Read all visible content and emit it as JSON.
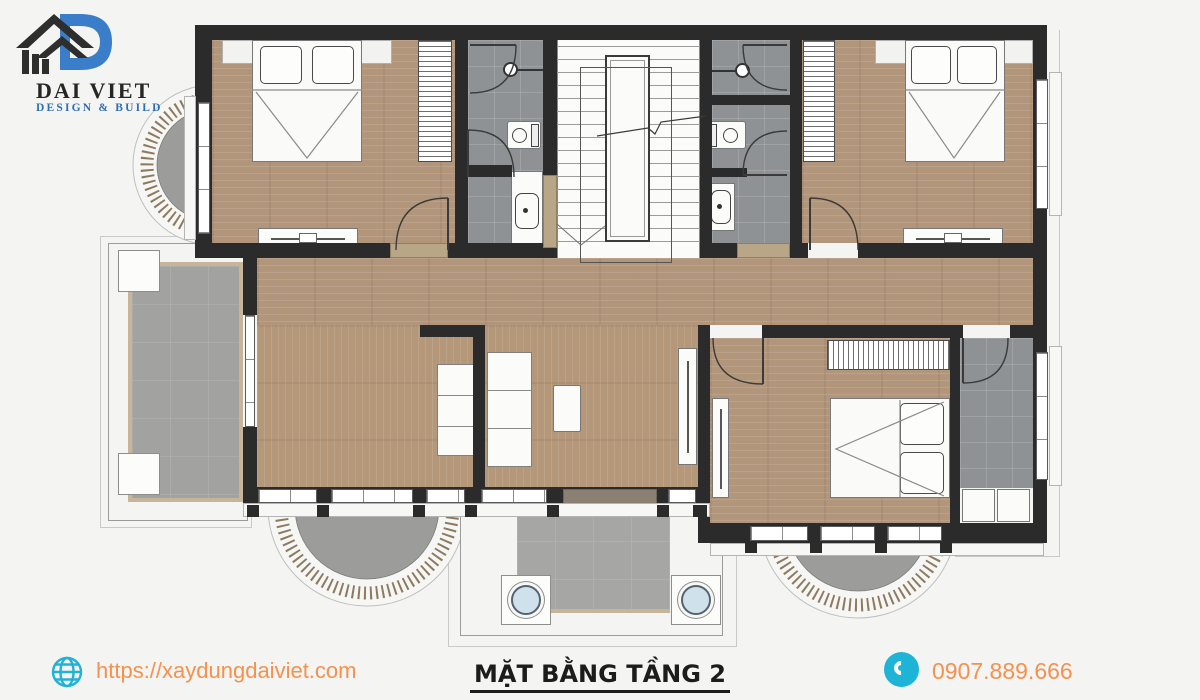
{
  "brand": {
    "name": "DAI VIET",
    "tagline": "DESIGN & BUILD"
  },
  "footer": {
    "website_url": "https://xaydungdaiviet.com",
    "plan_title": "MẶT BẰNG TẦNG 2",
    "phone_number": "0907.889.666"
  },
  "icons": {
    "logo_house": "house-roof-with-letter-D",
    "globe": "line-globe",
    "phone": "handset-in-circle"
  },
  "colors": {
    "accent_orange": "#f5914e",
    "accent_cyan": "#22b2d8",
    "logo_blue": "#3a7dc8",
    "wall_dark": "#2b2b2b",
    "wood_floor": "#b2967b",
    "bath_tile": "#8f9294",
    "balcony_tile": "#a2a2a0",
    "rail_tan": "#8d7b60"
  }
}
